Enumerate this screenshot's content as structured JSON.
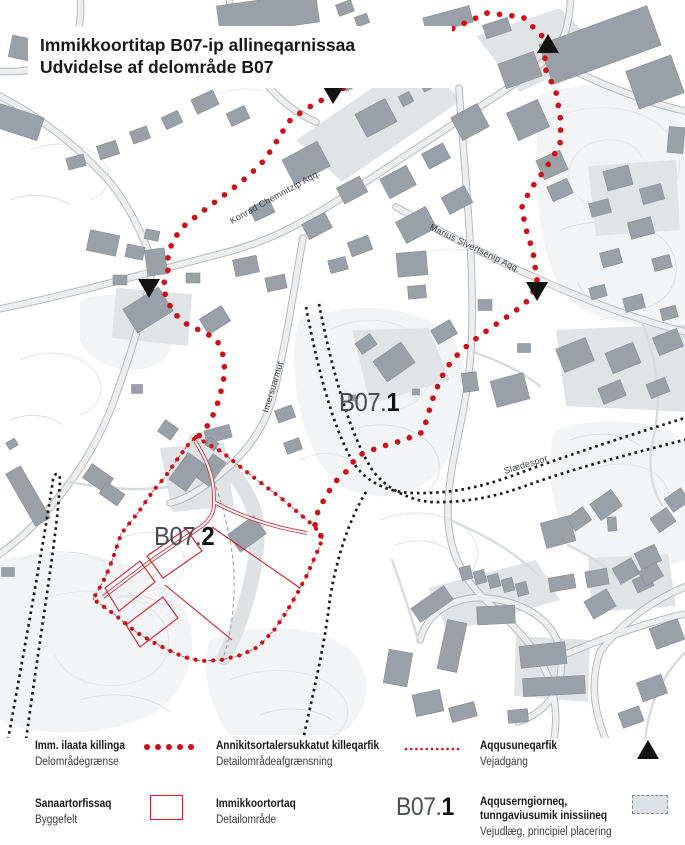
{
  "title": {
    "line1": "Immikkoortitap B07-ip allineqarnissaa",
    "line2": "Udvidelse af delområde B07"
  },
  "map": {
    "areas": [
      {
        "prefix": "B07.",
        "number": "1"
      },
      {
        "prefix": "B07.",
        "number": "2"
      }
    ],
    "streets": [
      {
        "name": "Konrad Chemnitzip Aqq."
      },
      {
        "name": "Marius Sivertsenip Aqq."
      },
      {
        "name": "Imersuarmut"
      },
      {
        "name": "Slædespor"
      }
    ]
  },
  "legend": {
    "items": [
      {
        "title": "Imm. ilaata killinga",
        "subtitle": "Delområdegrænse",
        "symbol": "large-red-dots"
      },
      {
        "title": "Annikitsortalersukkatut killeqarfik",
        "subtitle": "Detailområdeafgrænsning",
        "symbol": "fine-red-dots"
      },
      {
        "title": "Aqqusuneqarfik",
        "subtitle": "Vejadgang",
        "symbol": "road-access-triangle"
      },
      {
        "title": "Sanaartorfissaq",
        "subtitle": "Byggefelt",
        "symbol": "building-plot-rect"
      },
      {
        "title": "Immikkoortortaq",
        "subtitle": "Detailområde",
        "symbol": "area-code-sample",
        "sample_prefix": "B07.",
        "sample_number": "1"
      },
      {
        "title": "Aqquserngiorneq, tunngaviusumik inissiineq",
        "subtitle": "Vejudlæg, principiel placering",
        "symbol": "road-reservation-swatch"
      }
    ]
  },
  "colors": {
    "boundary_red": "#cc1118",
    "building_gray": "#9aa0a7",
    "track_black": "#1c1c1c",
    "road_reservation_fill": "#dde2e6"
  }
}
